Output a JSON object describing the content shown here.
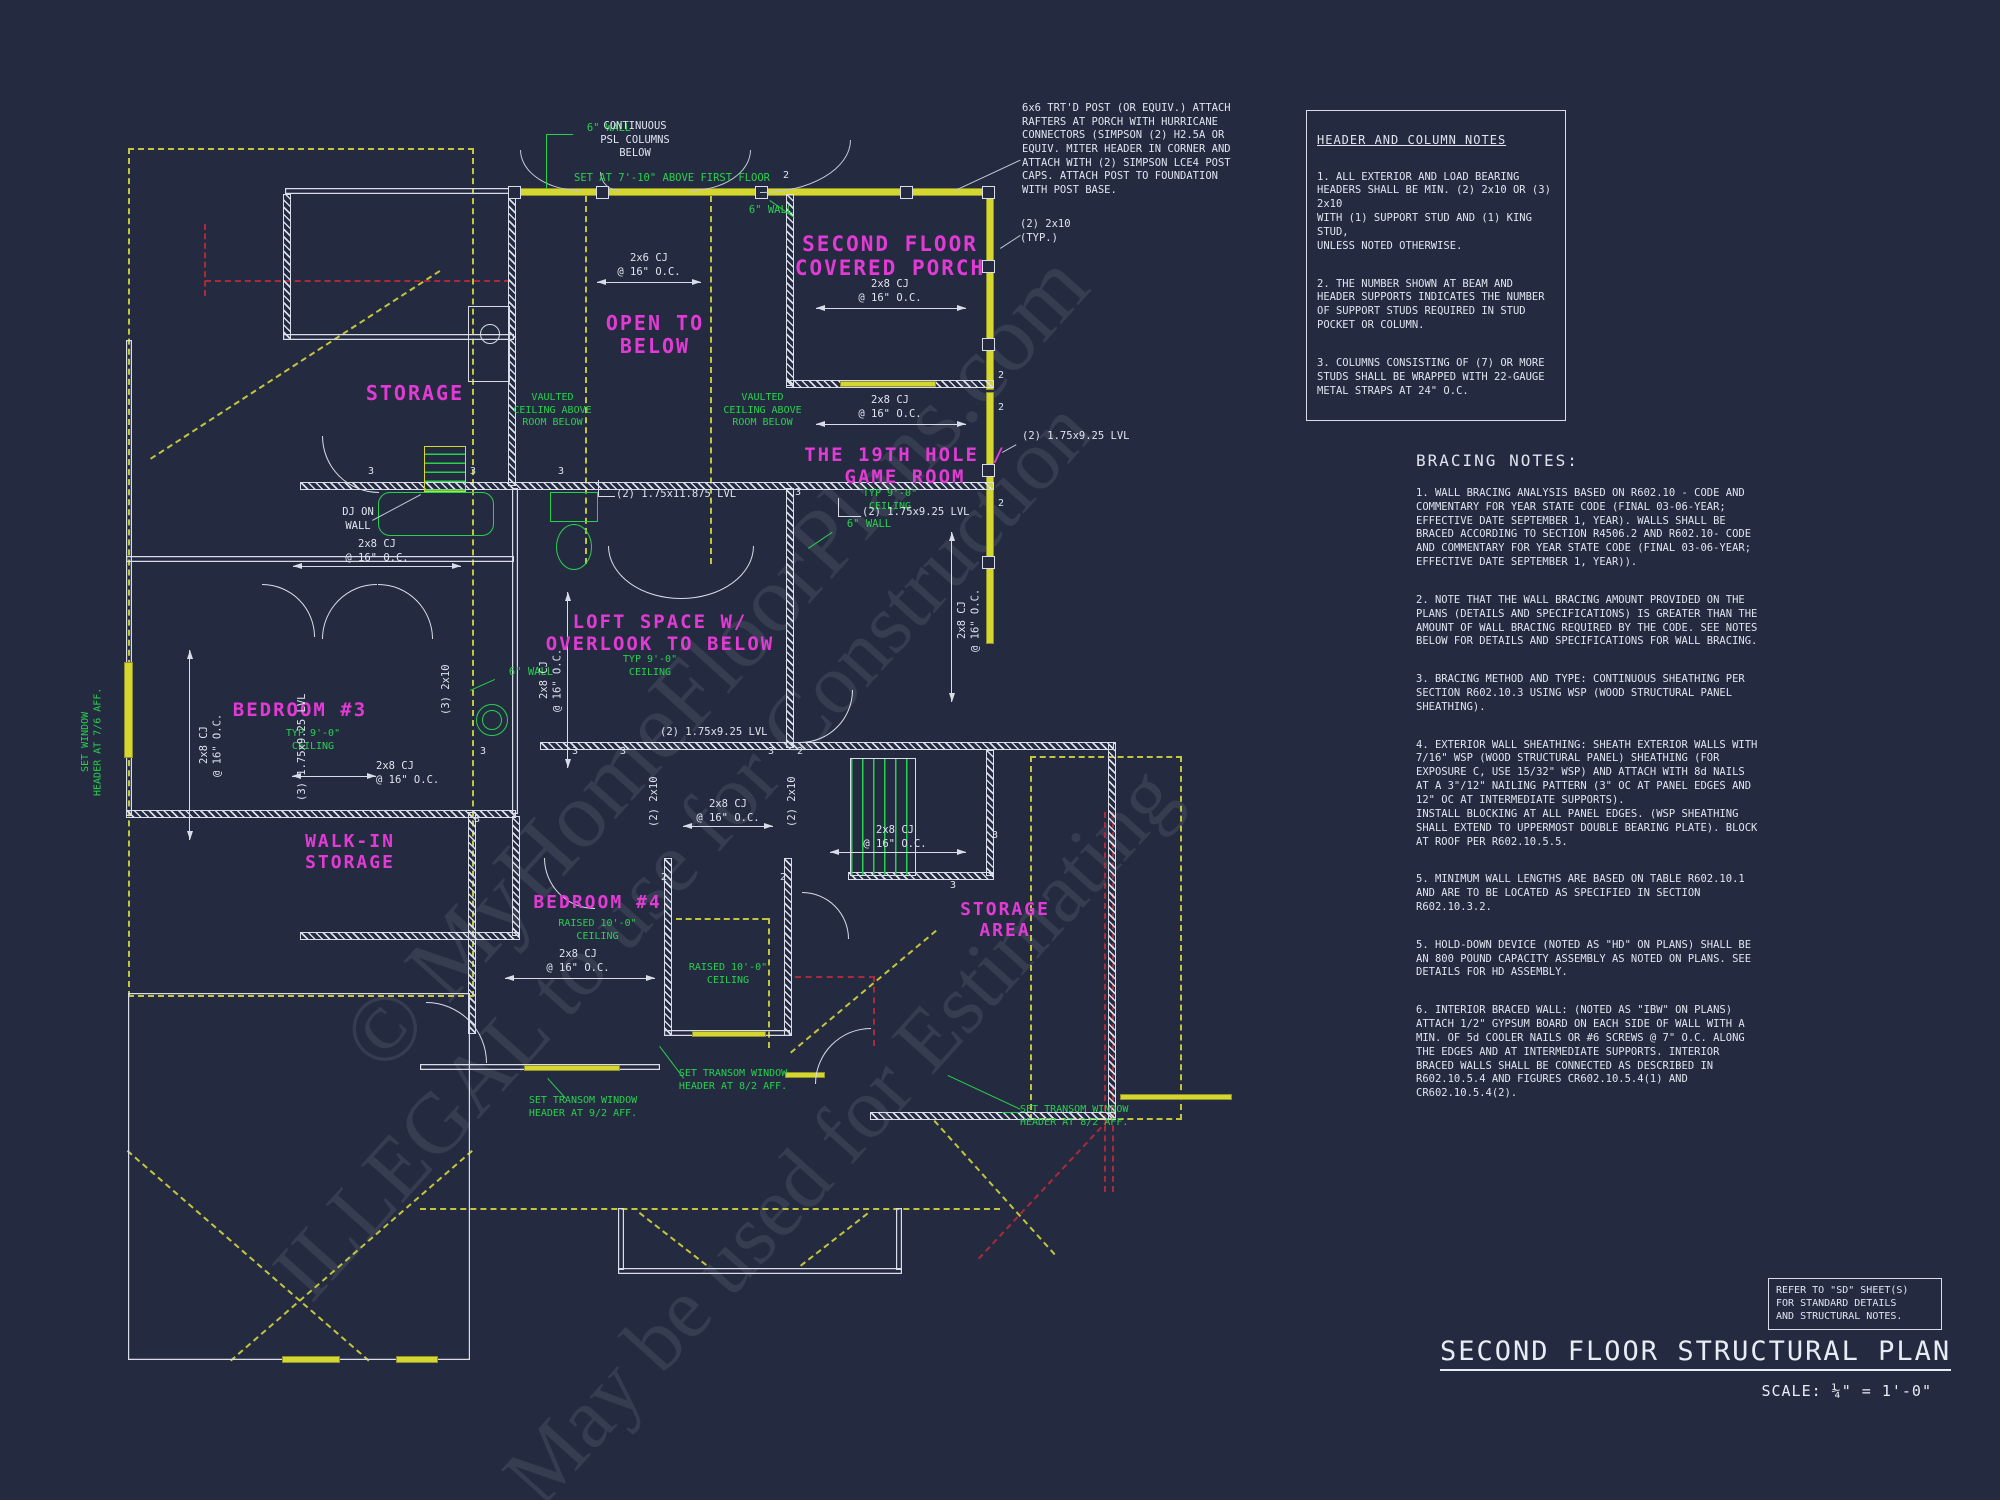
{
  "drawing": {
    "sheet_title": "SECOND FLOOR STRUCTURAL PLAN",
    "scale_label": "SCALE: ¼\" = 1'-0\"",
    "refer_note": "REFER TO \"SD\" SHEET(S)\nFOR STANDARD DETAILS\nAND STRUCTURAL NOTES."
  },
  "watermark": {
    "line1": "© MyHomeFloorPlans.com",
    "line2": "ILLEGAL to use for Construction",
    "line3": "May be used for Estimating"
  },
  "header_notes": {
    "title": "HEADER AND COLUMN NOTES",
    "note1": "1. ALL EXTERIOR AND LOAD BEARING\nHEADERS SHALL BE MIN. (2) 2x10 OR (3) 2x10\nWITH (1) SUPPORT STUD AND (1) KING STUD,\nUNLESS NOTED OTHERWISE.",
    "note2": "2. THE NUMBER SHOWN AT BEAM AND\nHEADER SUPPORTS INDICATES THE NUMBER\nOF SUPPORT STUDS REQUIRED IN STUD\nPOCKET OR COLUMN.",
    "note3": "3. COLUMNS CONSISTING OF (7) OR MORE\nSTUDS SHALL BE WRAPPED WITH 22-GAUGE\nMETAL STRAPS AT 24\" O.C."
  },
  "bracing_notes": {
    "title": "BRACING NOTES:",
    "note1": "1. WALL BRACING ANALYSIS BASED ON R602.10 - CODE AND COMMENTARY FOR YEAR STATE CODE (FINAL 03-06-YEAR; EFFECTIVE DATE SEPTEMBER 1, YEAR). WALLS SHALL BE BRACED ACCORDING TO SECTION R4506.2 AND R602.10- CODE AND COMMENTARY FOR YEAR STATE CODE (FINAL 03-06-YEAR; EFFECTIVE DATE SEPTEMBER 1, YEAR)).",
    "note2": "2. NOTE THAT THE WALL BRACING AMOUNT PROVIDED ON THE PLANS (DETAILS AND SPECIFICATIONS) IS GREATER THAN THE AMOUNT OF WALL BRACING REQUIRED BY THE CODE. SEE NOTES BELOW FOR DETAILS AND SPECIFICATIONS FOR WALL BRACING.",
    "note3": "3. BRACING METHOD AND TYPE: CONTINUOUS SHEATHING PER SECTION R602.10.3 USING WSP (WOOD STRUCTURAL PANEL SHEATHING).",
    "note4": "4. EXTERIOR WALL SHEATHING: SHEATH EXTERIOR WALLS WITH 7/16\" WSP (WOOD STRUCTURAL PANEL) SHEATHING (FOR EXPOSURE C, USE 15/32\" WSP) AND ATTACH WITH 8d NAILS AT A 3\"/12\" NAILING PATTERN (3\" OC AT PANEL EDGES AND 12\" OC AT INTERMEDIATE SUPPORTS).\nINSTALL BLOCKING AT ALL PANEL EDGES. (WSP SHEATHING SHALL EXTEND TO UPPERMOST DOUBLE BEARING PLATE). BLOCK AT ROOF PER R602.10.5.5.",
    "note5a": "5. MINIMUM WALL LENGTHS ARE BASED ON TABLE R602.10.1 AND ARE TO BE LOCATED AS SPECIFIED IN SECTION R602.10.3.2.",
    "note5b": "5. HOLD-DOWN DEVICE (NOTED AS \"HD\" ON PLANS) SHALL BE AN 800 POUND CAPACITY ASSEMBLY AS NOTED ON PLANS. SEE DETAILS FOR HD ASSEMBLY.",
    "note6": "6. INTERIOR BRACED WALL: (NOTED AS \"IBW\" ON PLANS) ATTACH 1/2\" GYPSUM BOARD ON EACH SIDE OF WALL WITH A MIN. OF 5d COOLER NAILS OR #6 SCREWS @ 7\" O.C. ALONG THE EDGES AND AT INTERMEDIATE SUPPORTS.  INTERIOR BRACED WALLS SHALL BE CONNECTED AS DESCRIBED IN R602.10.5.4 AND FIGURES CR602.10.5.4(1) AND CR602.10.5.4(2)."
  },
  "callouts": {
    "post_note": "6x6 TRT'D POST (OR EQUIV.) ATTACH\nRAFTERS AT PORCH WITH HURRICANE\nCONNECTORS (SIMPSON (2) H2.5A OR\nEQUIV.  MITER HEADER IN CORNER AND\nATTACH WITH (2) SIMPSON LCE4 POST\nCAPS.  ATTACH POST TO FOUNDATION\nWITH POST BASE.",
    "typ_2x10": "(2) 2x10\n(TYP.)",
    "continuous_psl": "CONTINUOUS\nPSL COLUMNS\nBELOW",
    "dj_on_wall": "DJ ON\nWALL"
  },
  "rooms": {
    "covered_porch": "SECOND FLOOR\nCOVERED PORCH",
    "open_to_below": "OPEN TO\nBELOW",
    "storage": "STORAGE",
    "game_room": "THE 19TH HOLE /\nGAME ROOM",
    "loft": "LOFT SPACE W/\nOVERLOOK TO BELOW",
    "bedroom3": "BEDROOM #3",
    "walk_in": "WALK-IN\nSTORAGE",
    "bedroom4": "BEDROOM #4",
    "storage_area": "STORAGE\nAREA"
  },
  "green_notes": {
    "wall6": "6\" WALL",
    "set_at": "SET AT 7'-10\" ABOVE FIRST FLOOR",
    "vaulted": "VAULTED\nCEILING ABOVE\nROOM BELOW",
    "typ9": "TYP 9'-0\"\nCEILING",
    "raised10": "RAISED 10'-0\"\nCEILING",
    "window_header": "SET WINDOW\nHEADER AT 7/6 AFF.",
    "transom92": "SET TRANSOM WINDOW\nHEADER  AT 9/2 AFF.",
    "transom82": "SET TRANSOM WINDOW\nHEADER  AT 8/2 AFF."
  },
  "dims": {
    "cj26": "2x6 CJ\n@ 16\" O.C.",
    "cj28": "2x8 CJ\n@ 16\" O.C."
  },
  "beams": {
    "lvl925_2": "(2) 1.75x9.25 LVL",
    "lvl11875_2": "(2) 1.75x11.875 LVL",
    "lvl925_3": "(3) 1.75x9.25 LVL",
    "p2x10_2": "(2) 2x10",
    "p2x10_3": "(3) 2x10"
  },
  "stud_counts": {
    "two": "2",
    "three": "3"
  }
}
